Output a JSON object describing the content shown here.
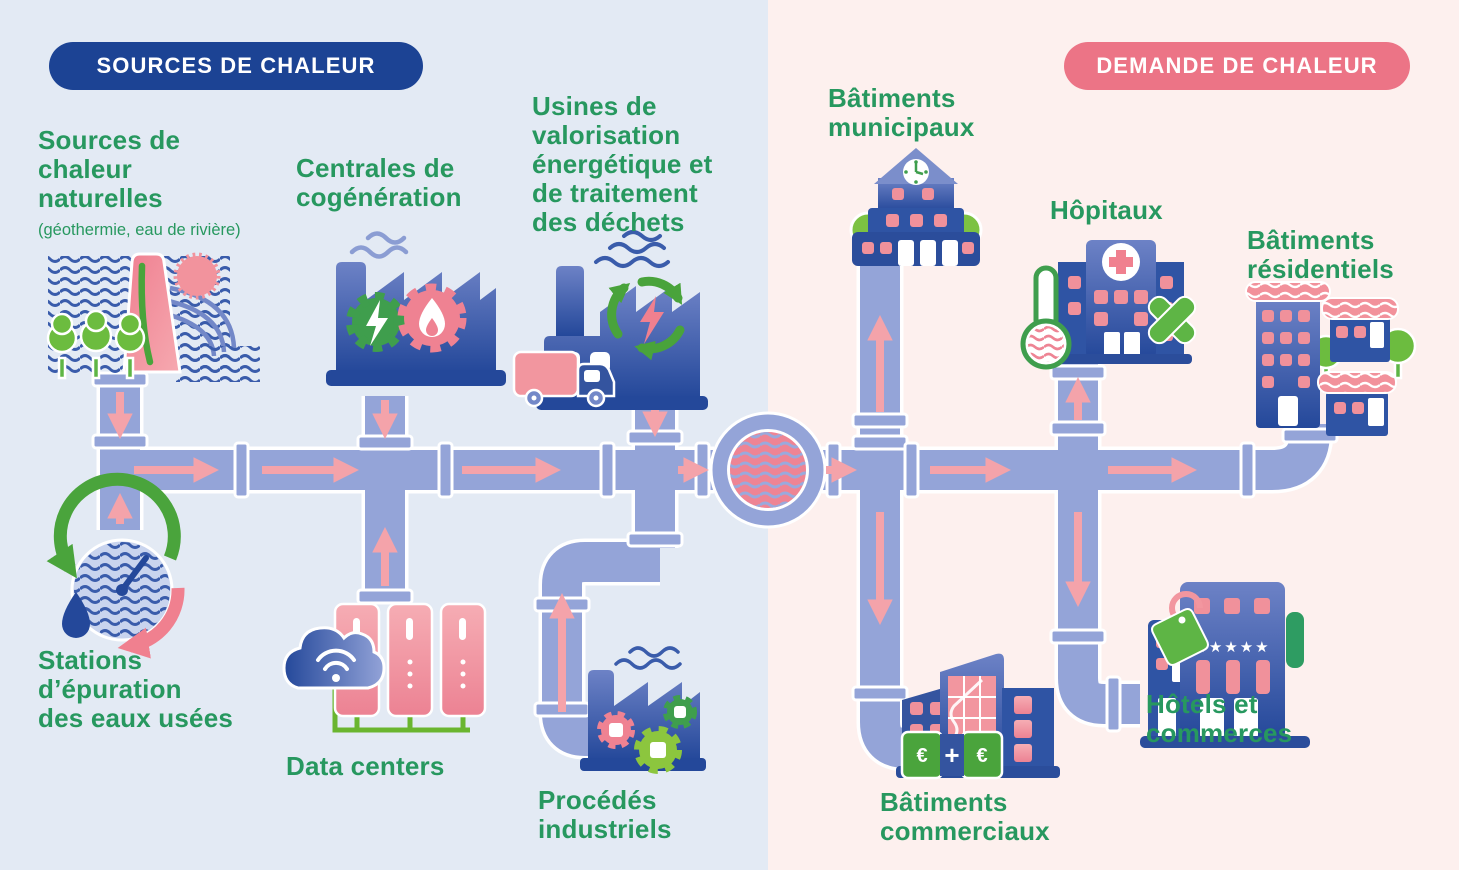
{
  "palette": {
    "background_left": "#e3eaf4",
    "background_right": "#fdf0ee",
    "source_badge_blue": "#1c4394",
    "demand_badge_pink": "#ec7486",
    "label_green": "#27985f",
    "pipe_periwinkle": "#94a4d8",
    "arrow_pink": "#f4a3aa",
    "building_blue": "#2b4d9b",
    "window_pink": "#f2939d",
    "accent_green": "#49a33b",
    "hub_pink": "#ee8494"
  },
  "left_panel": {
    "badge": "SOURCES DE CHALEUR",
    "items": [
      {
        "icon": "natural-heat-sources-icon",
        "label": "Sources de\nchaleur\nnaturelles",
        "sublabel": "(géothermie, eau de rivière)"
      },
      {
        "icon": "cogeneration-plant-icon",
        "label": "Centrales de\ncogénération"
      },
      {
        "icon": "waste-to-energy-plant-icon",
        "label": "Usines de\nvalorisation\nénergétique et\nde traitement\ndes déchets"
      },
      {
        "icon": "wastewater-treatment-icon",
        "label": "Stations\nd’épuration\ndes eaux usées"
      },
      {
        "icon": "data-center-icon",
        "label": "Data centers"
      },
      {
        "icon": "industrial-processes-icon",
        "label": "Procédés\nindustriels"
      }
    ]
  },
  "right_panel": {
    "badge": "DEMANDE DE CHALEUR",
    "items": [
      {
        "icon": "municipal-buildings-icon",
        "label": "Bâtiments\nmunicipaux"
      },
      {
        "icon": "hospitals-icon",
        "label": "Hôpitaux"
      },
      {
        "icon": "residential-buildings-icon",
        "label": "Bâtiments\nrésidentiels"
      },
      {
        "icon": "commercial-buildings-icon",
        "label": "Bâtiments\ncommerciaux"
      },
      {
        "icon": "hotels-shops-icon",
        "label": "Hôtels et\ncommerces"
      }
    ]
  },
  "icon_text": {
    "hotel_stars": "★★★★★",
    "euro_left": "€",
    "euro_right": "€",
    "plus": "+"
  }
}
